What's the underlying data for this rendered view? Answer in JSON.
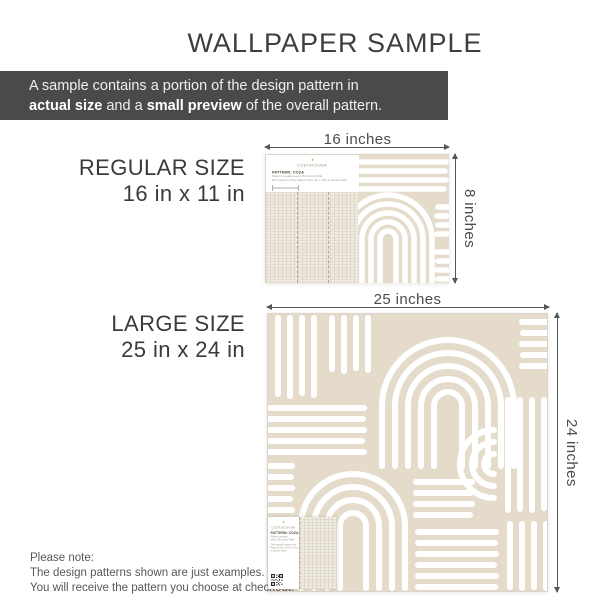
{
  "title": "WALLPAPER SAMPLE",
  "banner": {
    "line1": "A sample contains a portion of the design pattern in",
    "bold1": "actual size",
    "mid": " and a ",
    "bold2": "small preview",
    "tail": " of the overall pattern."
  },
  "regular": {
    "name": "REGULAR SIZE",
    "size": "16 in x 11 in",
    "width_label": "16 inches",
    "height_label": "8 inches"
  },
  "large": {
    "name": "LARGE SIZE",
    "size": "25 in x 24 in",
    "width_label": "25 inches",
    "height_label": "24 inches"
  },
  "swatch_card": {
    "brand": "COSTACOVER",
    "logo_glyph": "✦",
    "pattern_title": "PATTERN: COZA",
    "note_line1": "Pattern repeats every 25 inches Wide",
    "note_line2": "Mini swatch of the Pattern Size 4in x 13in in actual scale"
  },
  "large_sticker": {
    "brand": "COSTACOVER",
    "logo_glyph": "✦",
    "pattern_title": "PATTERN: COZA",
    "note_line1": "Pattern repeats",
    "note_line2": "every 25 inches Wide",
    "note_line3": "This sample shows the",
    "note_line4": "Pattern Size 25 in x 24 in",
    "note_line5": "in actual scale"
  },
  "footer_note": {
    "line1": "Please note:",
    "line2": "The design patterns shown are just examples.",
    "line3": "You will receive the pattern you choose at checkout."
  },
  "colors": {
    "banner_bg": "#4a4a4a",
    "pattern_beige": "#e4dbcb",
    "texture_beige": "#f0ebe1",
    "stroke_white": "#ffffff",
    "gold": "#b5985a",
    "text_dark": "#3e3e3e",
    "dim_text": "#4c4c4c"
  }
}
